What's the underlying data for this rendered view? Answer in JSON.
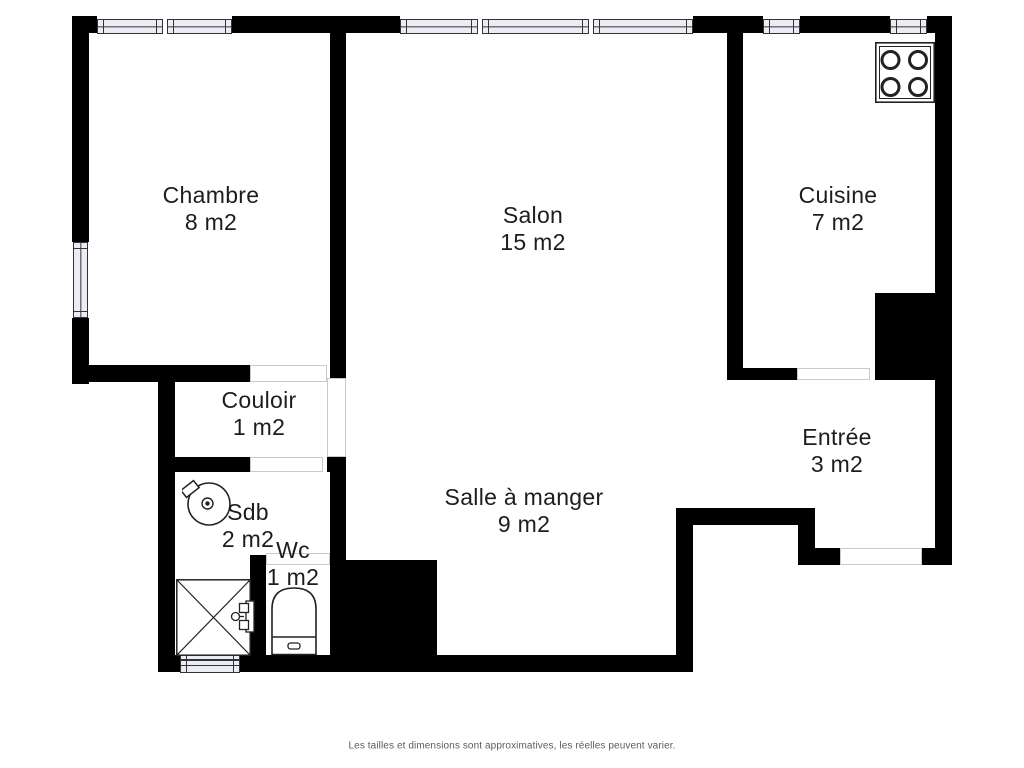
{
  "plan_type": "apartment-floor-plan",
  "rooms": {
    "chambre": {
      "name": "Chambre",
      "area": "8 m2"
    },
    "salon": {
      "name": "Salon",
      "area": "15 m2"
    },
    "cuisine": {
      "name": "Cuisine",
      "area": "7 m2"
    },
    "couloir": {
      "name": "Couloir",
      "area": "1 m2"
    },
    "salle_a_manger": {
      "name": "Salle à manger",
      "area": "9 m2"
    },
    "entree": {
      "name": "Entrée",
      "area": "3 m2"
    },
    "sdb": {
      "name": "Sdb",
      "area": "2 m2"
    },
    "wc": {
      "name": "Wc",
      "area": "1 m2"
    }
  },
  "fixtures": [
    "stove-icon",
    "sink-icon",
    "shower-icon",
    "toilet-icon",
    "door-leaf-icon"
  ],
  "window_count": 6,
  "door_opening_count": 6,
  "disclaimer": "Les tailles et dimensions sont approximatives, les réelles peuvent varier.",
  "colors": {
    "wall": "#000000",
    "window_fill": "#ECECF4",
    "window_border": "#333333",
    "door_line": "#c9c9cf",
    "fixture_line": "#222222",
    "text": "#1d1d1f",
    "disclaimer_text": "#5c5c60",
    "background": "#ffffff"
  }
}
